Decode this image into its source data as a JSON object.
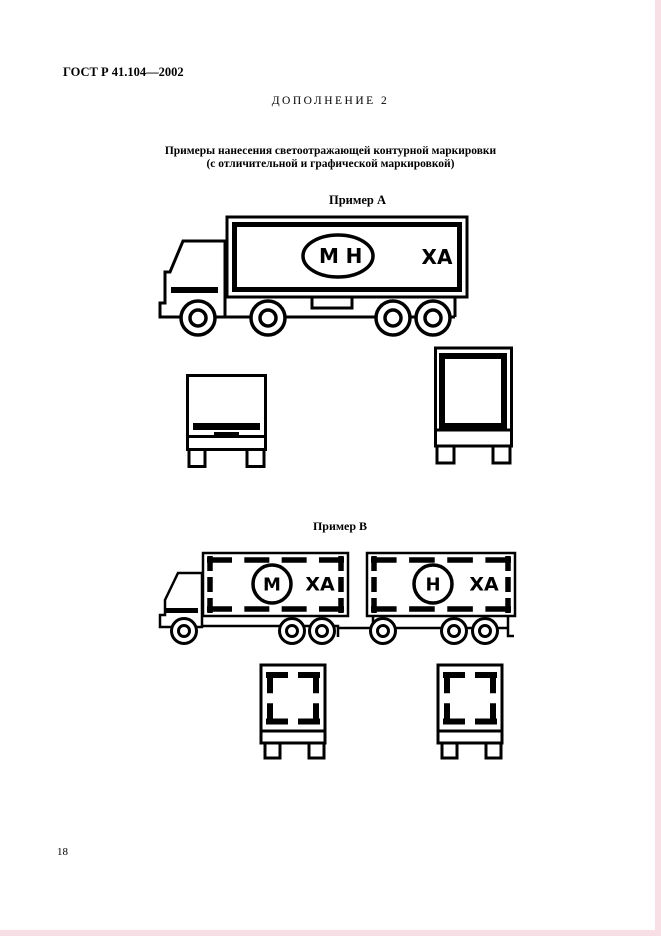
{
  "page": {
    "doc_number": "ГОСТ Р 41.104—2002",
    "supplement_label": "ДОПОЛНЕНИЕ 2",
    "title_line1": "Примеры нанесения светоотражающей контурной маркировки",
    "title_line2": "(с отличительной и графической маркировкой)",
    "page_number": "18"
  },
  "example_a": {
    "label": "Пример А",
    "oval_letter_left": "М",
    "oval_letter_right": "Н",
    "plate_text": "ХА"
  },
  "example_b": {
    "label": "Пример В",
    "truck_circle_letter": "М",
    "truck_plate_text": "ХА",
    "trailer_circle_letter": "Н",
    "trailer_plate_text": "ХА"
  },
  "colors": {
    "ink": "#000000",
    "paper": "#ffffff",
    "edge_tint": "#f7dfe5"
  }
}
